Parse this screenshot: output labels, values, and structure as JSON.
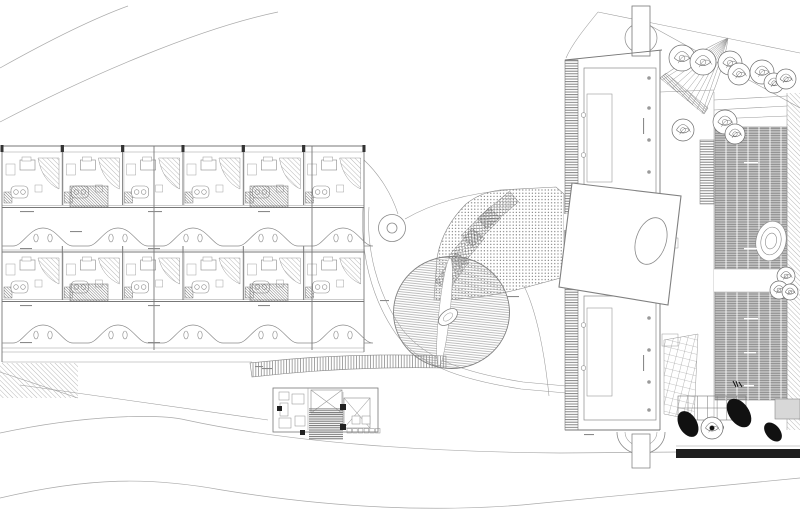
{
  "drawing": {
    "kind": "architectural-site-plan",
    "description": "monochrome line-work site plan: long hotel wing with repeated room modules at left, circular timber deck and stippled plaza at centre, gallery building with louvred decks, trees and rock garden at right, topographic contour lines top-left and bottom"
  },
  "palette": {
    "paper": "#ffffff",
    "ink": "#777777",
    "light_ink": "#9a9a9a",
    "poche": "#6b6b6b",
    "deck_gray": "#c6c6c6",
    "louver_line": "#7a7a7a",
    "black_band": "#1f1f1f"
  },
  "left_building": {
    "unit_count_per_row": 6,
    "row_count": 2,
    "x0": 2,
    "unit_w": 60.33,
    "rows": [
      {
        "y": 152,
        "h": 53
      },
      {
        "y": 252,
        "h": 48
      }
    ],
    "joints": [
      154,
      312
    ],
    "stair_blocks": [
      {
        "x": 70,
        "y": 186,
        "w": 38,
        "h": 21
      },
      {
        "x": 250,
        "y": 186,
        "w": 38,
        "h": 21
      },
      {
        "x": 70,
        "y": 284,
        "w": 38,
        "h": 17
      },
      {
        "x": 250,
        "y": 284,
        "w": 38,
        "h": 17
      }
    ]
  },
  "terraces": {
    "bump_centers": [
      43,
      118,
      193,
      268,
      343
    ],
    "bands": [
      {
        "top": 207.5,
        "base": 246,
        "peak": 228,
        "oval_y": 238,
        "bot": 250
      },
      {
        "top": 301.5,
        "base": 343,
        "peak": 325,
        "oval_y": 335,
        "bot": 348
      }
    ]
  },
  "plaza": {
    "stair_bands": [
      {
        "x": 452,
        "y": 272,
        "w": 36,
        "h": 16,
        "rot": -55
      },
      {
        "x": 466,
        "y": 248,
        "w": 38,
        "h": 16,
        "rot": -50
      },
      {
        "x": 481,
        "y": 227,
        "w": 40,
        "h": 16,
        "rot": -45
      },
      {
        "x": 498,
        "y": 210,
        "w": 42,
        "h": 14,
        "rot": -40
      }
    ]
  },
  "right_building": {
    "wall_circle_ys": [
      115,
      155,
      198,
      240,
      282,
      325,
      368
    ],
    "column_x": 649,
    "column_ys_upper": [
      78,
      108,
      140,
      172,
      204
    ],
    "column_ys_lower": [
      318,
      350,
      382,
      410
    ],
    "deck_strips": [
      {
        "x": 715,
        "y": 127,
        "w": 72,
        "h": 142
      },
      {
        "x": 715,
        "y": 292,
        "w": 72,
        "h": 108
      }
    ],
    "deck_separator_step": 11
  },
  "trees": {
    "road": [
      [
        682,
        58,
        13
      ],
      [
        703,
        62,
        13
      ],
      [
        730,
        63,
        12
      ],
      [
        739,
        74,
        11
      ],
      [
        762,
        72,
        12
      ],
      [
        774,
        83,
        10
      ],
      [
        786,
        79,
        10
      ]
    ],
    "courtyard": [
      [
        683,
        130,
        11
      ],
      [
        725,
        122,
        12
      ],
      [
        735,
        134,
        10
      ]
    ],
    "garden": [
      [
        786,
        276,
        9
      ],
      [
        779,
        290,
        9
      ],
      [
        790,
        292,
        8
      ]
    ],
    "dark": [
      [
        712,
        428,
        11
      ]
    ]
  },
  "rocks": [
    [
      688,
      424,
      9,
      14,
      -30
    ],
    [
      739,
      413,
      10,
      16,
      -35
    ],
    [
      773,
      432,
      7,
      11,
      -40
    ],
    [
      716,
      429,
      8,
      5,
      -20
    ]
  ],
  "small_building": {
    "furniture": [
      [
        279,
        392,
        10,
        8
      ],
      [
        292,
        394,
        12,
        10
      ],
      [
        280,
        403,
        8,
        13
      ],
      [
        279,
        418,
        12,
        10
      ],
      [
        295,
        416,
        10,
        10
      ],
      [
        352,
        416,
        8,
        8
      ],
      [
        362,
        416,
        8,
        8
      ]
    ],
    "black_squares": [
      [
        277,
        406,
        5
      ],
      [
        340,
        404,
        6
      ],
      [
        340,
        424,
        6
      ],
      [
        300,
        430,
        5
      ]
    ],
    "bottom_square_count": 6
  },
  "contours": {
    "top": [
      "M0,68 C50,40 95,18 128,6",
      "M0,122 C90,75 200,28 278,12"
    ],
    "bottom": [
      "M0,433 C90,414 160,414 186,420 C292,443 430,452 560,453 L680,452",
      "M0,498 C90,477 150,477 222,490 C332,508 432,512 522,505 C622,496 722,486 800,478"
    ]
  },
  "micro_labels": {
    "dark": [
      [
        20,
        211,
        14
      ],
      [
        148,
        211,
        14
      ],
      [
        258,
        211,
        12
      ],
      [
        70,
        231,
        12
      ],
      [
        20,
        248,
        12
      ],
      [
        148,
        248,
        12
      ],
      [
        20,
        305,
        12
      ],
      [
        148,
        305,
        12
      ],
      [
        258,
        305,
        12
      ],
      [
        20,
        342,
        12
      ],
      [
        148,
        342,
        12
      ],
      [
        262,
        368,
        10
      ],
      [
        255,
        366,
        8
      ],
      [
        507,
        296,
        12
      ],
      [
        584,
        434,
        10
      ],
      [
        380,
        300,
        9
      ]
    ],
    "white": [
      [
        744,
        162,
        14
      ],
      [
        744,
        248,
        14
      ],
      [
        744,
        318,
        14
      ],
      [
        744,
        352,
        12
      ],
      [
        744,
        385,
        10
      ],
      [
        735,
        282,
        12
      ]
    ],
    "vertical": [
      [
        643,
        118,
        16
      ],
      [
        643,
        355,
        16
      ]
    ]
  }
}
